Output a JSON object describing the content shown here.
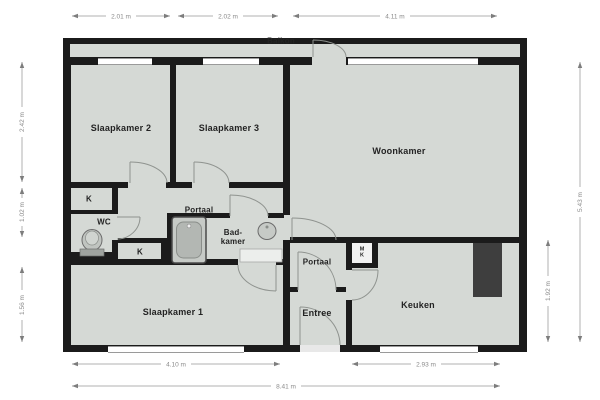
{
  "rooms": {
    "balkon": "Balkon",
    "slaapkamer2": "Slaapkamer 2",
    "slaapkamer3": "Slaapkamer 3",
    "woonkamer": "Woonkamer",
    "portaal1": "Portaal",
    "badkamer": "Bad-\nkamer",
    "wc": "WC",
    "kast1": "K",
    "kast2": "K",
    "meterkast": "M\nK",
    "portaal2": "Portaal",
    "entree": "Entree",
    "keuken": "Keuken",
    "slaapkamer1": "Slaapkamer 1"
  },
  "dimensions": {
    "top": [
      "2.01 m",
      "2.02 m",
      "4.11 m"
    ],
    "bottom_segments": [
      "4.10 m",
      "2.93 m"
    ],
    "bottom_total": "8.41 m",
    "left": [
      "2.42 m",
      "1.02 m",
      "1.56 m"
    ],
    "right_inner": "1.92 m",
    "right_outer": "5.43 m"
  },
  "fixtures": {
    "bathtub": "bathtub",
    "toilet": "toilet",
    "sink": "sink",
    "kitchen_counter": "kitchen-counter",
    "bath_mat": "bath-mat"
  },
  "colors": {
    "floor": "#d5d9d5",
    "wall": "#1b1b1b",
    "counter": "#3e3e3e",
    "dimension_text": "#8a8a8a",
    "background": "#ffffff"
  }
}
